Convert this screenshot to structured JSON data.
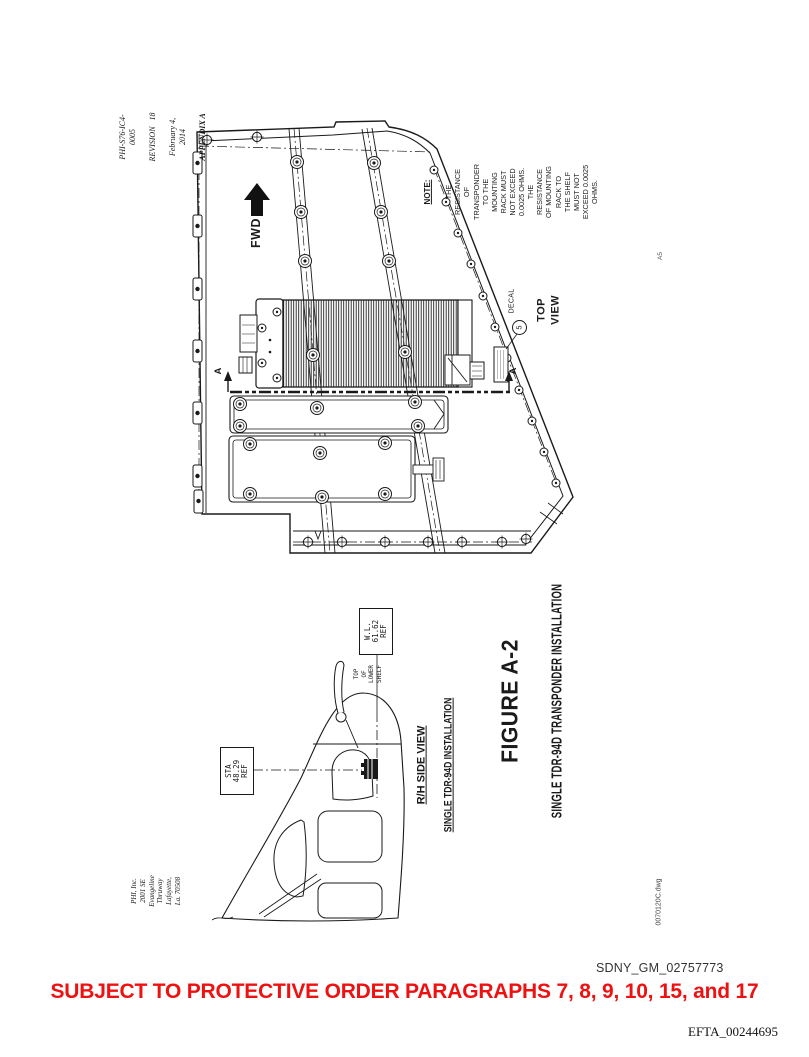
{
  "title_block": {
    "doc_number": "PHI-S76-IC4-0005",
    "revision": "REVISION   18",
    "date": "February 4, 2014",
    "appendix": "APPENDIX A"
  },
  "top_view": {
    "fwd_label": "FWD",
    "note_title": "NOTE:",
    "note_body": "THE RESISTANCE OF TRANSPONDER TO THE\nMOUNTING RACK MUST NOT EXCEED 0.0025 OHMS.\nTHE RESISTANCE OF MOUNTING RACK TO\nTHE SHELF MUST NOT EXCEED 0.0025 OHMS.",
    "balloon_number": "5",
    "balloon_label": "DECAL",
    "view_label": "TOP VIEW",
    "section_letter": "A",
    "grid_ref": "A5"
  },
  "side_view": {
    "wl_box": "W.L.\n61.62\nREF",
    "shelf_note": "TOP OF\nLOWER SHELF",
    "sta_box": "STA\n48.29\nREF",
    "view_label": "R/H SIDE VIEW",
    "view_sublabel": "SINGLE TDR-94D INSTALLATION"
  },
  "figure": {
    "number": "FIGURE A-2",
    "title": "SINGLE TDR-94D TRANSPONDER INSTALLATION"
  },
  "company_block": "PHI, Inc.\n2001 SE Evangeline Thruway\nLafayette, La. 70508",
  "drawing_file": "0070120C.dwg",
  "footer": {
    "bates_sdny": "SDNY_GM_02757773",
    "protective_order": "SUBJECT TO PROTECTIVE ORDER PARAGRAPHS 7, 8, 9, 10, 15, and 17",
    "bates_efta": "EFTA_00244695"
  },
  "colors": {
    "ink": "#1a1a1a",
    "protective_order_red": "#ee1111"
  }
}
